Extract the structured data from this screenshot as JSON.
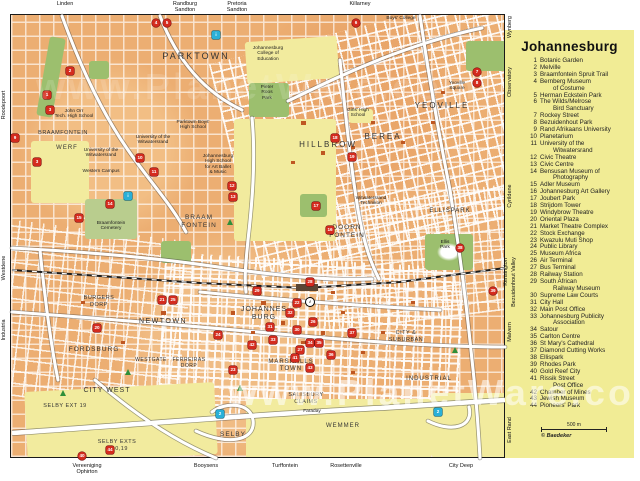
{
  "watermark": {
    "text": "www.PlanetWare.com"
  },
  "legend": {
    "title": "Johannesburg",
    "scale_label": "500 m",
    "copyright": "© Baedeker",
    "items": [
      {
        "n": 1,
        "lines": [
          "Botanic Garden"
        ]
      },
      {
        "n": 2,
        "lines": [
          "Melville"
        ]
      },
      {
        "n": 3,
        "lines": [
          "Braamfontein Spruit Trail"
        ]
      },
      {
        "n": 4,
        "lines": [
          "Bernberg Museum",
          "of Costume"
        ]
      },
      {
        "n": 5,
        "lines": [
          "Herman Eckstein Park"
        ]
      },
      {
        "n": 6,
        "lines": [
          "The Wilds/Melrose",
          "Bird Sanctuary"
        ]
      },
      {
        "n": 7,
        "lines": [
          "Rockey Street"
        ]
      },
      {
        "n": 8,
        "lines": [
          "Bezuidenhout Park"
        ]
      },
      {
        "n": 9,
        "lines": [
          "Rand Afrikaans University"
        ]
      },
      {
        "n": 10,
        "lines": [
          "Planetarium"
        ]
      },
      {
        "n": 11,
        "lines": [
          "University of the",
          "Witwatersrand"
        ]
      },
      {
        "n": 12,
        "lines": [
          "Civic Theatre"
        ]
      },
      {
        "n": 13,
        "lines": [
          "Civic Centre"
        ]
      },
      {
        "n": 14,
        "lines": [
          "Bensusan Museum of",
          "Photography"
        ]
      },
      {
        "n": 15,
        "lines": [
          "Adler Museum"
        ]
      },
      {
        "n": 16,
        "lines": [
          "Johannesburg Art Gallery"
        ]
      },
      {
        "n": 17,
        "lines": [
          "Joubert Park"
        ]
      },
      {
        "n": 18,
        "lines": [
          "Strijdom Tower"
        ]
      },
      {
        "n": 19,
        "lines": [
          "Windybrow Theatre"
        ]
      },
      {
        "n": 20,
        "lines": [
          "Oriental Plaza"
        ]
      },
      {
        "n": 21,
        "lines": [
          "Market Theatre Complex"
        ]
      },
      {
        "n": 22,
        "lines": [
          "Stock Exchange"
        ]
      },
      {
        "n": 23,
        "lines": [
          "Kwazulu Muti Shop"
        ]
      },
      {
        "n": 24,
        "lines": [
          "Public Library"
        ]
      },
      {
        "n": 25,
        "lines": [
          "Museum Africa"
        ]
      },
      {
        "n": 26,
        "lines": [
          "Air Terminal"
        ]
      },
      {
        "n": 27,
        "lines": [
          "Bus Terminal"
        ]
      },
      {
        "n": 28,
        "lines": [
          "Railway Station"
        ]
      },
      {
        "n": 29,
        "lines": [
          "South African",
          "Railway Museum"
        ]
      },
      {
        "n": 30,
        "lines": [
          "Supreme Law Courts"
        ]
      },
      {
        "n": 31,
        "lines": [
          "City Hall"
        ]
      },
      {
        "n": 32,
        "lines": [
          "Main Post Office"
        ]
      },
      {
        "n": 33,
        "lines": [
          "Johannesburg Publicity",
          "Association"
        ]
      },
      {
        "n": 34,
        "lines": [
          "Satour"
        ]
      },
      {
        "n": 35,
        "lines": [
          "Carlton Centre"
        ]
      },
      {
        "n": 36,
        "lines": [
          "St Mary's Cathedral"
        ]
      },
      {
        "n": 37,
        "lines": [
          "Diamond Cutting Works"
        ]
      },
      {
        "n": 38,
        "lines": [
          "Ellispark"
        ]
      },
      {
        "n": 39,
        "lines": [
          "Rhodes Park"
        ]
      },
      {
        "n": 40,
        "lines": [
          "Gold Reef City"
        ]
      },
      {
        "n": 41,
        "lines": [
          "Rissik Street",
          "Post Office"
        ]
      },
      {
        "n": 42,
        "lines": [
          "Chamber of Mines"
        ]
      },
      {
        "n": 43,
        "lines": [
          "Jewish Museum"
        ]
      },
      {
        "n": 44,
        "lines": [
          "Pioneers' Park"
        ]
      }
    ]
  },
  "map": {
    "edge_labels": {
      "top": [
        {
          "lines": [
            "Linden"
          ],
          "x": 65
        },
        {
          "lines": [
            "Randburg",
            "Sandton"
          ],
          "x": 185
        },
        {
          "lines": [
            "Pretoria",
            "Sandton"
          ],
          "x": 237
        },
        {
          "lines": [
            "Killarney"
          ],
          "x": 360
        }
      ],
      "bottom": [
        {
          "lines": [
            "Vereeniging",
            "Ophirton"
          ],
          "x": 87
        },
        {
          "lines": [
            "Booysens"
          ],
          "x": 206
        },
        {
          "lines": [
            "Turffontein"
          ],
          "x": 285
        },
        {
          "lines": [
            "Rosettenville"
          ],
          "x": 346
        },
        {
          "lines": [
            "City Deep"
          ],
          "x": 461
        }
      ],
      "left": [
        {
          "text": "Roodepoort",
          "y": 105,
          "dx": 0
        },
        {
          "text": "Westdene",
          "y": 268,
          "dx": 0
        },
        {
          "text": "Industria",
          "y": 330,
          "dx": 0
        }
      ],
      "right": [
        {
          "text": "Wynberg",
          "y": 27,
          "dx": 5
        },
        {
          "text": "Observatory",
          "y": 82,
          "dx": 5
        },
        {
          "text": "Cyrildene",
          "y": 196,
          "dx": 5
        },
        {
          "text": "Kensington",
          "y": 272,
          "dx": 1
        },
        {
          "text": "Bezuidenhout Valley",
          "y": 282,
          "dx": 9
        },
        {
          "text": "Malvern",
          "y": 332,
          "dx": 5
        },
        {
          "text": "East Rand",
          "y": 430,
          "dx": 5
        }
      ]
    },
    "districts": [
      {
        "lines": [
          "PARKTOWN"
        ],
        "x": 195,
        "y": 50,
        "s": 9,
        "ls": 2
      },
      {
        "lines": [
          "BRAAMFONTEIN"
        ],
        "x": 62,
        "y": 129,
        "s": 5.5,
        "ls": 0.5
      },
      {
        "lines": [
          "WERF"
        ],
        "x": 66,
        "y": 144,
        "s": 6,
        "ls": 1
      },
      {
        "lines": [
          "HILLBROW"
        ],
        "x": 327,
        "y": 139,
        "s": 8,
        "ls": 2
      },
      {
        "lines": [
          "BEREA"
        ],
        "x": 382,
        "y": 131,
        "s": 8,
        "ls": 2
      },
      {
        "lines": [
          "YEOVILLE"
        ],
        "x": 441,
        "y": 100,
        "s": 8,
        "ls": 2
      },
      {
        "lines": [
          "BRAAM",
          "FONTEIN"
        ],
        "x": 198,
        "y": 213,
        "s": 6.5,
        "ls": 1
      },
      {
        "lines": [
          "DOORN",
          "FONTEIN"
        ],
        "x": 346,
        "y": 223,
        "s": 6.5,
        "ls": 1
      },
      {
        "lines": [
          "ELLISPARK"
        ],
        "x": 449,
        "y": 207,
        "s": 6,
        "ls": 1
      },
      {
        "lines": [
          "NEWTOWN"
        ],
        "x": 162,
        "y": 317,
        "s": 7,
        "ls": 1.5
      },
      {
        "lines": [
          "JOHANNES",
          "BURG"
        ],
        "x": 263,
        "y": 305,
        "s": 7,
        "ls": 1
      },
      {
        "lines": [
          "MARSHALLS",
          "TOWN"
        ],
        "x": 290,
        "y": 358,
        "s": 6,
        "ls": 1
      },
      {
        "lines": [
          "FORDSBURG"
        ],
        "x": 93,
        "y": 345,
        "s": 6.5,
        "ls": 1
      },
      {
        "lines": [
          "BURGERS",
          "DORP"
        ],
        "x": 98,
        "y": 294,
        "s": 5.5,
        "ls": 0.5
      },
      {
        "lines": [
          "WESTGATE"
        ],
        "x": 150,
        "y": 356,
        "s": 5,
        "ls": 0.5
      },
      {
        "lines": [
          "FERREIRAS",
          "DORP"
        ],
        "x": 188,
        "y": 356,
        "s": 5,
        "ls": 0.5
      },
      {
        "lines": [
          "CITY WEST"
        ],
        "x": 106,
        "y": 386,
        "s": 7,
        "ls": 1
      },
      {
        "lines": [
          "SELBY EXT 19"
        ],
        "x": 64,
        "y": 402,
        "s": 5.5,
        "ls": 0.5
      },
      {
        "lines": [
          "SELBY EXTS",
          "5,10,19"
        ],
        "x": 116,
        "y": 438,
        "s": 5.5,
        "ls": 0.5
      },
      {
        "lines": [
          "SELBY"
        ],
        "x": 232,
        "y": 430,
        "s": 6.5,
        "ls": 1
      },
      {
        "lines": [
          "SALISBURY",
          "CLAIMS"
        ],
        "x": 305,
        "y": 391,
        "s": 5.5,
        "ls": 0.5
      },
      {
        "lines": [
          "WEMMER"
        ],
        "x": 342,
        "y": 422,
        "s": 6,
        "ls": 1
      },
      {
        "lines": [
          "INDUSTRIAL"
        ],
        "x": 428,
        "y": 375,
        "s": 6,
        "ls": 1
      },
      {
        "lines": [
          "CITY &",
          "SUBURBAN"
        ],
        "x": 405,
        "y": 329,
        "s": 5.5,
        "ls": 0.5
      }
    ],
    "places": [
      {
        "lines": [
          "John Orr",
          "Tech. High School"
        ],
        "x": 73,
        "y": 108
      },
      {
        "lines": [
          "University of the",
          "Witwatersrand"
        ],
        "x": 100,
        "y": 147
      },
      {
        "lines": [
          "Western Campus"
        ],
        "x": 100,
        "y": 168
      },
      {
        "lines": [
          "University of the",
          "Witwatersrand"
        ],
        "x": 152,
        "y": 134
      },
      {
        "lines": [
          "Parktown Boys'",
          "High School"
        ],
        "x": 192,
        "y": 119
      },
      {
        "lines": [
          "Johannesburg",
          "High School",
          "for Art Ballet",
          "& Music"
        ],
        "x": 217,
        "y": 153
      },
      {
        "lines": [
          "Johannesburg",
          "College of",
          "Education"
        ],
        "x": 267,
        "y": 45
      },
      {
        "lines": [
          "St. John's",
          "Boys' College"
        ],
        "x": 400,
        "y": 10
      },
      {
        "lines": [
          "Girls' High",
          "School"
        ],
        "x": 357,
        "y": 107
      },
      {
        "lines": [
          "Witwatersrand",
          "Technikon"
        ],
        "x": 370,
        "y": 195
      },
      {
        "lines": [
          "Pieter",
          "Roos",
          "Park"
        ],
        "x": 266,
        "y": 84
      },
      {
        "lines": [
          "Ellis",
          "Park"
        ],
        "x": 444,
        "y": 239
      },
      {
        "lines": [
          "Braamfontein",
          "Cemetery"
        ],
        "x": 110,
        "y": 220
      },
      {
        "lines": [
          "Yeoville",
          "Square"
        ],
        "x": 456,
        "y": 80
      },
      {
        "lines": [
          "Faraday"
        ],
        "x": 311,
        "y": 408
      }
    ],
    "sight_markers": [
      {
        "n": "1",
        "x": 47,
        "y": 95
      },
      {
        "n": "2",
        "x": 70,
        "y": 71
      },
      {
        "n": "3",
        "x": 50,
        "y": 110
      },
      {
        "n": "3",
        "x": 37,
        "y": 162
      },
      {
        "n": "4",
        "x": 156,
        "y": 23,
        "round": true
      },
      {
        "n": "5",
        "x": 167,
        "y": 23,
        "round": true
      },
      {
        "n": "6",
        "x": 356,
        "y": 23,
        "round": true
      },
      {
        "n": "7",
        "x": 477,
        "y": 72,
        "round": true
      },
      {
        "n": "8",
        "x": 477,
        "y": 83,
        "round": true
      },
      {
        "n": "9",
        "x": 15,
        "y": 138
      },
      {
        "n": "10",
        "x": 140,
        "y": 158
      },
      {
        "n": "11",
        "x": 154,
        "y": 172
      },
      {
        "n": "12",
        "x": 232,
        "y": 186
      },
      {
        "n": "13",
        "x": 233,
        "y": 197
      },
      {
        "n": "14",
        "x": 110,
        "y": 204
      },
      {
        "n": "15",
        "x": 79,
        "y": 218
      },
      {
        "n": "16",
        "x": 330,
        "y": 230
      },
      {
        "n": "17",
        "x": 316,
        "y": 206
      },
      {
        "n": "18",
        "x": 335,
        "y": 138
      },
      {
        "n": "19",
        "x": 352,
        "y": 157
      },
      {
        "n": "20",
        "x": 97,
        "y": 328
      },
      {
        "n": "21",
        "x": 162,
        "y": 300
      },
      {
        "n": "22",
        "x": 297,
        "y": 303
      },
      {
        "n": "23",
        "x": 233,
        "y": 370
      },
      {
        "n": "24",
        "x": 218,
        "y": 335
      },
      {
        "n": "25",
        "x": 173,
        "y": 300
      },
      {
        "n": "26",
        "x": 313,
        "y": 322
      },
      {
        "n": "27",
        "x": 300,
        "y": 350
      },
      {
        "n": "28",
        "x": 310,
        "y": 282
      },
      {
        "n": "29",
        "x": 257,
        "y": 291
      },
      {
        "n": "30",
        "x": 297,
        "y": 330
      },
      {
        "n": "31",
        "x": 270,
        "y": 327
      },
      {
        "n": "32",
        "x": 290,
        "y": 313
      },
      {
        "n": "33",
        "x": 273,
        "y": 340
      },
      {
        "n": "34",
        "x": 310,
        "y": 343
      },
      {
        "n": "35",
        "x": 319,
        "y": 343
      },
      {
        "n": "36",
        "x": 331,
        "y": 355
      },
      {
        "n": "37",
        "x": 352,
        "y": 333
      },
      {
        "n": "38",
        "x": 460,
        "y": 248,
        "round": true
      },
      {
        "n": "39",
        "x": 493,
        "y": 291,
        "round": true
      },
      {
        "n": "40",
        "x": 82,
        "y": 456,
        "round": true
      },
      {
        "n": "41",
        "x": 295,
        "y": 358
      },
      {
        "n": "42",
        "x": 252,
        "y": 345
      },
      {
        "n": "43",
        "x": 310,
        "y": 368
      },
      {
        "n": "44",
        "x": 110,
        "y": 450
      }
    ],
    "info_markers": [
      {
        "t": "i",
        "x": 216,
        "y": 35,
        "style": "cyan"
      },
      {
        "t": "i",
        "x": 128,
        "y": 196,
        "style": "cyan"
      },
      {
        "t": "2",
        "x": 220,
        "y": 414,
        "style": "cyan"
      },
      {
        "t": "2",
        "x": 438,
        "y": 412,
        "style": "cyan"
      },
      {
        "t": "i",
        "x": 310,
        "y": 302,
        "style": "white"
      }
    ],
    "tree_symbols": [
      {
        "x": 128,
        "y": 372
      },
      {
        "x": 240,
        "y": 388
      },
      {
        "x": 63,
        "y": 393
      },
      {
        "x": 455,
        "y": 350
      },
      {
        "x": 230,
        "y": 222
      }
    ]
  },
  "colors": {
    "map_base": "#ecae72",
    "area_yellow": "#f2eb9e",
    "park_green": "#9cbf6e",
    "legend_bg": "#f1ec95",
    "sight_red": "#d42b1e",
    "info_cyan": "#29b0d8"
  }
}
